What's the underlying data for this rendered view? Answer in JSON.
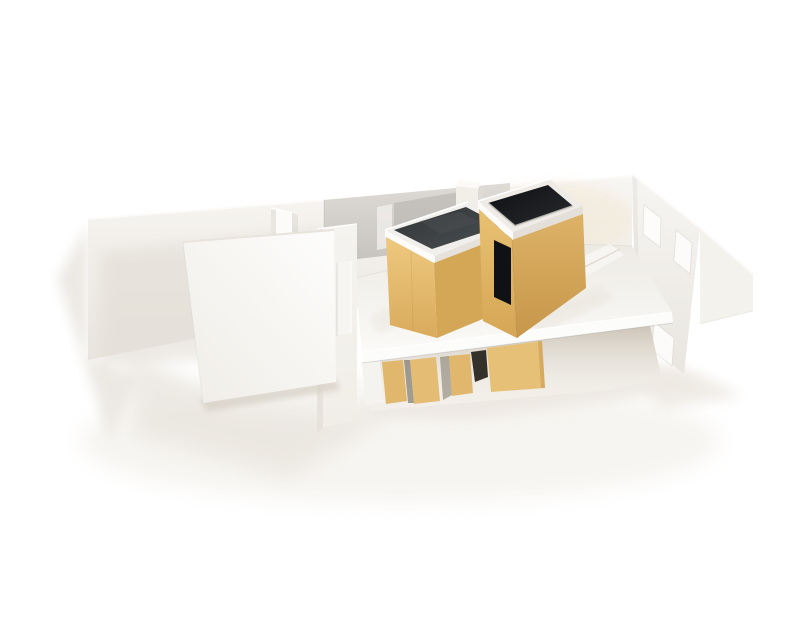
{
  "image": {
    "type": "photograph",
    "subject": "Architectural scale model of a long narrow two-level interior, built from white foam board with two gold cardboard volumes, photographed from a high front angle on a white surface",
    "width_px": 800,
    "height_px": 600,
    "background_color": "#ffffff",
    "contains_text": false
  },
  "palette": {
    "background_white": "#ffffff",
    "foam_white": "#f5f3ef",
    "foam_bright": "#fcfcfb",
    "foam_shade": "#e9e5de",
    "table_shadow": "#e7e2da",
    "gold_light": "#e9c277",
    "gold_mid": "#dcb062",
    "gold_dark": "#c9994a",
    "roof_charcoal": "#383c3e",
    "void_black": "#131417",
    "mirror_gray": "#d2cfcb"
  },
  "model_parts": {
    "scene": "Photo of white architectural model with gold tower volumes",
    "ground_shadows": "Soft warm shadows cast on white table",
    "back_wall": "Long white back wall in perspective with mirrored strip",
    "mirror_strip": "Reflective mirrored panel on back wall behind towers",
    "fin_wall": "Short white fin wall projecting from back wall",
    "chimney": "Small white block behind the towers",
    "right_wall": "Right end wall with rectangular window openings",
    "right_extension": "White wall flap extending to the right",
    "lower_level": "Open lower level under the floor slab with gold columns",
    "floor_slab": "White upper floor slab with bright front fascia",
    "stairs": "Small white staircase with tilted side rail",
    "left_tower": "Gold volume with closed dark charcoal lid and white rim",
    "right_tower": "Gold volume with open dark top, white rim and black doorway",
    "left_wall": "White front-left wall with narrow vertical slot window",
    "front_panel": "Large freestanding white panel in the left foreground"
  }
}
